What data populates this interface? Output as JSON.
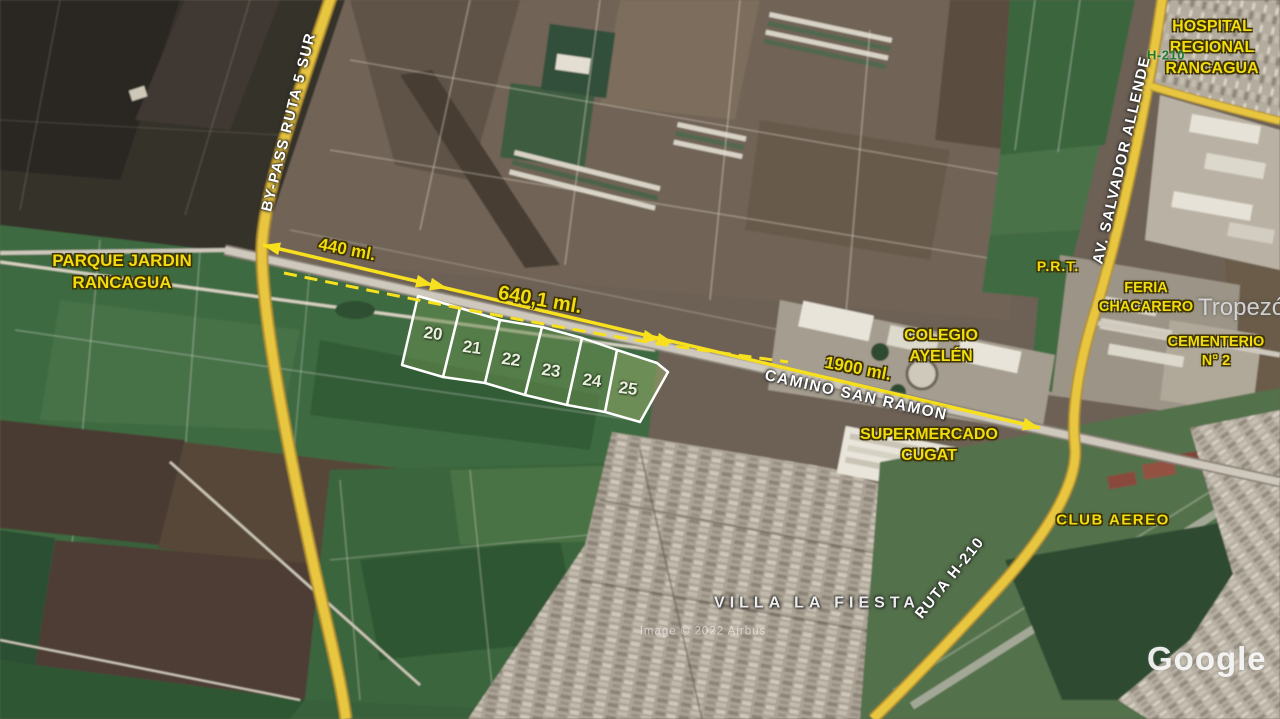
{
  "canvas": {
    "width": 1280,
    "height": 719
  },
  "labels": {
    "bypass": "BY-PASS RUTA 5 SUR",
    "parque1": "PARQUE JARDIN",
    "parque2": "RANCAGUA",
    "hospital1": "HOSPITAL",
    "hospital2": "REGIONAL",
    "hospital3": "RANCAGUA",
    "route_badge": "H-210",
    "allende": "AV. SALVADOR ALLENDE",
    "prt": "P.R.T.",
    "feria1": "FERIA",
    "feria2": "CHACARERO",
    "tropezon": "Tropezón",
    "cementerio1": "CEMENTERIO",
    "cementerio2": "N° 2",
    "colegio1": "COLEGIO",
    "colegio2": "AYELÉN",
    "supermercado1": "SUPERMERCADO",
    "supermercado2": "CUGAT",
    "camino": "CAMINO SAN RAMON",
    "club_aereo": "CLUB AEREO",
    "ruta_h210": "RUTA H-210",
    "villa": "VILLA LA FIESTA"
  },
  "measurements": {
    "m440": "440 ml.",
    "m640": "640,1 ml.",
    "m1900": "1900 ml."
  },
  "lots": [
    {
      "number": "20"
    },
    {
      "number": "21"
    },
    {
      "number": "22"
    },
    {
      "number": "23"
    },
    {
      "number": "24"
    },
    {
      "number": "25"
    }
  ],
  "watermark": {
    "logo": "Google",
    "credit": "Image © 2022 Airbus"
  },
  "colors": {
    "annotation_yellow": "#f2dc0f",
    "road_label_white": "#ffffff",
    "route_green": "#1f7a2e",
    "lot_border": "#ffffff",
    "highway_yellow": "#e9c640"
  }
}
